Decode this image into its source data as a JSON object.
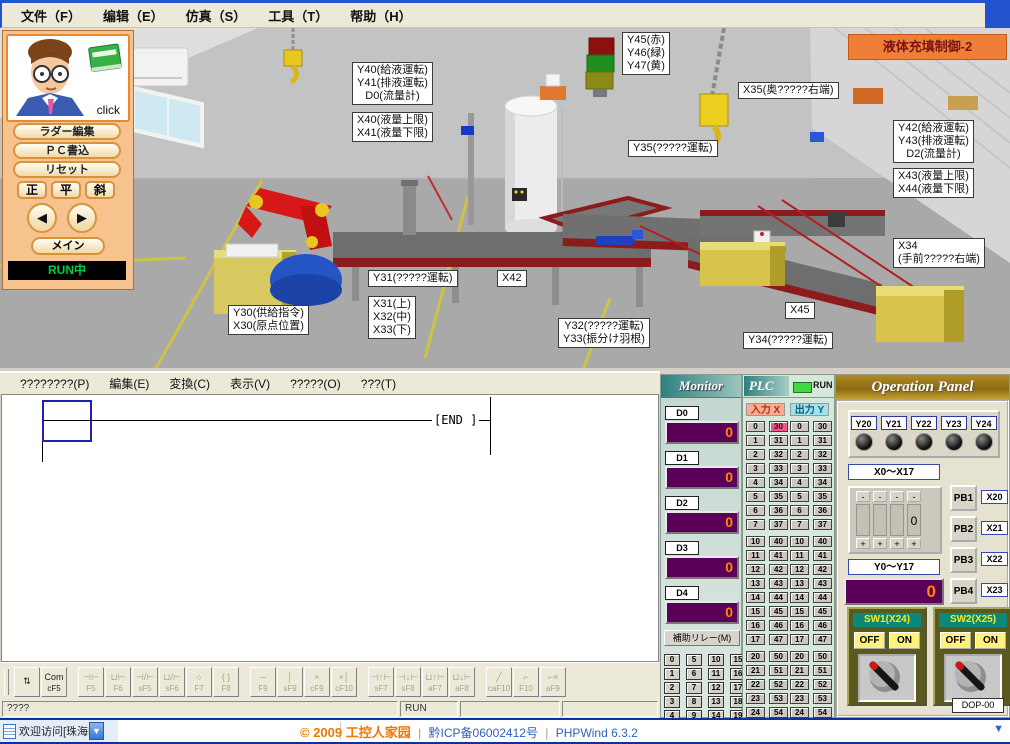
{
  "window": {
    "menu": [
      "文件（F）",
      "编辑（E）",
      "仿真（S）",
      "工具（T）",
      "帮助（H）"
    ]
  },
  "sim": {
    "banner": "液体充填制御-2",
    "panel": {
      "click": "click",
      "buttons": [
        "ラダー編集",
        "ＰＣ書込",
        "リセット"
      ],
      "button_names": [
        "ladder-edit-button",
        "pc-write-button",
        "reset-button"
      ],
      "pose_buttons": [
        "正",
        "平",
        "斜"
      ],
      "prev": "◀",
      "next": "▶",
      "main": "メイン",
      "status": "RUN中"
    },
    "labels": [
      {
        "id": "lbl-y40",
        "lines": [
          "Y40(給液運転)",
          "Y41(排液運転)",
          "D0(流量計)"
        ]
      },
      {
        "id": "lbl-x40",
        "lines": [
          "X40(液量上限)",
          "X41(液量下限)"
        ]
      },
      {
        "id": "lbl-y45",
        "lines": [
          "Y45(赤)",
          "Y46(緑)",
          "Y47(黄)"
        ]
      },
      {
        "id": "lbl-x35",
        "lines": [
          "X35(奥?????右端)"
        ]
      },
      {
        "id": "lbl-y35",
        "lines": [
          "Y35(?????運転)"
        ]
      },
      {
        "id": "lbl-y42",
        "lines": [
          "Y42(給液運転)",
          "Y43(排液運転)",
          "D2(流量計)"
        ]
      },
      {
        "id": "lbl-x43",
        "lines": [
          "X43(液量上限)",
          "X44(液量下限)"
        ]
      },
      {
        "id": "lbl-x34",
        "lines": [
          "X34",
          "(手前?????右端)"
        ]
      },
      {
        "id": "lbl-y31",
        "lines": [
          "Y31(?????運転)"
        ]
      },
      {
        "id": "lbl-x42",
        "lines": [
          "X42"
        ]
      },
      {
        "id": "lbl-x31",
        "lines": [
          "X31(上)",
          "X32(中)",
          "X33(下)"
        ]
      },
      {
        "id": "lbl-y30",
        "lines": [
          "Y30(供給指令)",
          "X30(原点位置)"
        ]
      },
      {
        "id": "lbl-y32",
        "lines": [
          "Y32(?????運転)",
          "Y33(振分け羽根)"
        ]
      },
      {
        "id": "lbl-x45",
        "lines": [
          "X45"
        ]
      },
      {
        "id": "lbl-y34",
        "lines": [
          "Y34(?????運転)"
        ]
      }
    ]
  },
  "ladder": {
    "menu": [
      "????????(P)",
      "編集(E)",
      "変換(C)",
      "表示(V)",
      "?????(O)",
      "???(T)"
    ],
    "end_label": "[END   ]",
    "toolbar": [
      {
        "sym": "⇅",
        "label": "",
        "name": "mode",
        "disabled": false
      },
      {
        "sym": "Com",
        "label": "cF5",
        "name": "com",
        "disabled": false
      },
      {
        "gap": true
      },
      {
        "sym": "⊣⊢",
        "label": "F5",
        "disabled": true
      },
      {
        "sym": "⊔⊢",
        "label": "F6",
        "disabled": true
      },
      {
        "sym": "⊣/⊢",
        "label": "sF5",
        "disabled": true
      },
      {
        "sym": "⊔/⊢",
        "label": "sF6",
        "disabled": true
      },
      {
        "sym": "○",
        "label": "F7",
        "disabled": true
      },
      {
        "sym": "{ }",
        "label": "F8",
        "disabled": true
      },
      {
        "gap": true
      },
      {
        "sym": "─",
        "label": "F9",
        "disabled": true
      },
      {
        "sym": "│",
        "label": "sF9",
        "disabled": true
      },
      {
        "sym": "×",
        "label": "cF9",
        "disabled": true
      },
      {
        "sym": "×│",
        "label": "cF10",
        "disabled": true
      },
      {
        "gap": true
      },
      {
        "sym": "⊣↑⊢",
        "label": "sF7",
        "disabled": true
      },
      {
        "sym": "⊣↓⊢",
        "label": "sF8",
        "disabled": true
      },
      {
        "sym": "⊔↑⊢",
        "label": "aF7",
        "disabled": true
      },
      {
        "sym": "⊔↓⊢",
        "label": "aF8",
        "disabled": true
      },
      {
        "gap": true
      },
      {
        "sym": "╱",
        "label": "caF10",
        "disabled": true
      },
      {
        "sym": "⌐",
        "label": "F10",
        "disabled": true
      },
      {
        "sym": "⌐×",
        "label": "aF9",
        "disabled": true
      }
    ],
    "status": {
      "left": "????",
      "run": "RUN"
    }
  },
  "monitor": {
    "title": "Monitor",
    "registers": [
      {
        "name": "D0",
        "value": "0"
      },
      {
        "name": "D1",
        "value": "0"
      },
      {
        "name": "D2",
        "value": "0"
      },
      {
        "name": "D3",
        "value": "0"
      },
      {
        "name": "D4",
        "value": "0"
      }
    ],
    "aux_button": "補助リレー(M)",
    "grid": [
      [
        "0",
        "5",
        "10",
        "15"
      ],
      [
        "1",
        "6",
        "11",
        "16"
      ],
      [
        "2",
        "7",
        "12",
        "17"
      ],
      [
        "3",
        "8",
        "13",
        "18"
      ],
      [
        "4",
        "9",
        "14",
        "19"
      ]
    ]
  },
  "plc": {
    "title": "PLC",
    "run": "RUN",
    "input_header": "入力 X",
    "output_header": "出力 Y",
    "blocks": [
      {
        "left": [
          "0",
          "1",
          "2",
          "3",
          "4",
          "5",
          "6",
          "7"
        ],
        "right": [
          "30",
          "31",
          "32",
          "33",
          "34",
          "35",
          "36",
          "37"
        ]
      },
      {
        "left": [
          "10",
          "11",
          "12",
          "13",
          "14",
          "15",
          "16",
          "17"
        ],
        "right": [
          "40",
          "41",
          "42",
          "43",
          "44",
          "45",
          "46",
          "47"
        ]
      },
      {
        "left": [
          "20",
          "21",
          "22",
          "23",
          "24",
          "25",
          "26",
          "27"
        ],
        "right": [
          "50",
          "51",
          "52",
          "53",
          "54",
          "55",
          "56",
          "57"
        ]
      }
    ],
    "x_on": [
      "30"
    ],
    "y_on": []
  },
  "op": {
    "title": "Operation Panel",
    "lamps": [
      "Y20",
      "Y21",
      "Y22",
      "Y23",
      "Y24"
    ],
    "x_range": "X0～X17",
    "stepper": {
      "minus": "-",
      "plus": "+",
      "digits": [
        "",
        "",
        "",
        "0"
      ]
    },
    "pb": [
      {
        "label": "PB1",
        "x": "X20"
      },
      {
        "label": "PB2",
        "x": "X21"
      },
      {
        "label": "PB3",
        "x": "X22"
      },
      {
        "label": "PB4",
        "x": "X23"
      }
    ],
    "y_range": "Y0～Y17",
    "y_value": "0",
    "switches": [
      {
        "label": "SW1(X24)",
        "off": "OFF",
        "on": "ON"
      },
      {
        "label": "SW2(X25)",
        "off": "OFF",
        "on": "ON"
      }
    ],
    "model": "DOP-00"
  },
  "footer": {
    "left_text": "欢迎访问[珠海R",
    "arrow": "▼",
    "copyright": "© 2009 工控人家园",
    "sep": "|",
    "icp": "黔ICP备06002412号",
    "engine": "PHPWind 6.3.2",
    "chevron": "▼"
  },
  "colors": {
    "banner_bg": "#EF7F38",
    "banner_text": "#7A1414",
    "panel_bg": "#F6C28E",
    "btn_border": "#D8943C",
    "run_text": "#00CC44",
    "display_bg": "#5A0058",
    "display_text": "#FF8A00",
    "x_on": "#F0558C",
    "input_hdr_bg": "#F8AC94",
    "input_hdr_text": "#B03010",
    "output_hdr_bg": "#A0E0F0",
    "output_hdr_text": "#106070",
    "plc_run": "#43D843",
    "sw_bg": "#5A5A20",
    "sw_label_bg": "#0C8878",
    "sw_label_text": "#FFE81C",
    "onoff_bg": "#FFF27C",
    "blue_strip": "#2353CD",
    "link_blue": "#3060C0",
    "copy_orange": "#F07800"
  }
}
